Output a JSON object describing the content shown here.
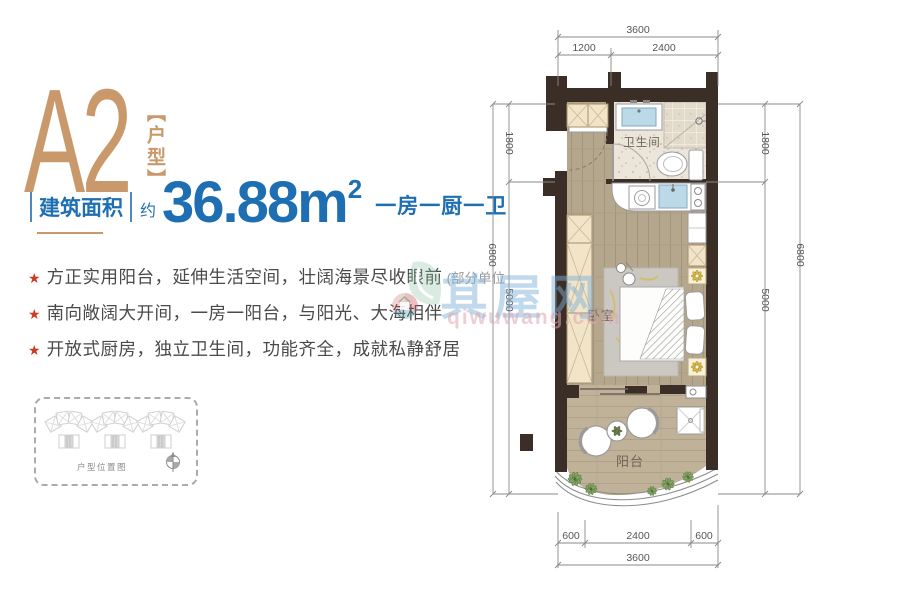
{
  "unit": {
    "code": "A2",
    "type_tag": "【户型】"
  },
  "area": {
    "label": "建筑面积",
    "approx": "约",
    "value": "36.88m",
    "sup": "2",
    "layout": "一房一厨一卫"
  },
  "features": [
    {
      "star": "★",
      "text": "方正实用阳台，延伸生活空间，壮阔海景尽收眼前",
      "note": "(部分单位"
    },
    {
      "star": "★",
      "text": "南向敞阔大开间，一房一阳台，与阳光、大海相伴",
      "note": ""
    },
    {
      "star": "★",
      "text": "开放式厨房，独立卫生间，功能齐全，成就私静舒居",
      "note": ""
    }
  ],
  "location": {
    "caption": "户型位置图"
  },
  "plan": {
    "rooms": {
      "bathroom": "卫生间",
      "bedroom": "卧室",
      "balcony": "阳台"
    },
    "dims": {
      "top_total": "3600",
      "top_a": "1200",
      "top_b": "2400",
      "bottom_a": "600",
      "bottom_b": "2400",
      "bottom_c": "600",
      "bottom_total": "3600",
      "side_a": "1800",
      "side_b": "5000",
      "side_total": "6800"
    }
  },
  "watermark": {
    "name": "其屋网",
    "site": "qiwuwang.com"
  },
  "colors": {
    "accent_tan": "#C9996B",
    "blue": "#1E6FB2",
    "star_red": "#CF3B22",
    "wall": "#3B2E27",
    "wood": "#B5A78D",
    "balcony_wood": "#C0B298",
    "bath_tile": "#EBE5DA",
    "cabinet": "#F1E4C8",
    "sink_blue": "#BCD9E8",
    "plant_gold": "#C9A227",
    "plant_green": "#6F8F55"
  }
}
